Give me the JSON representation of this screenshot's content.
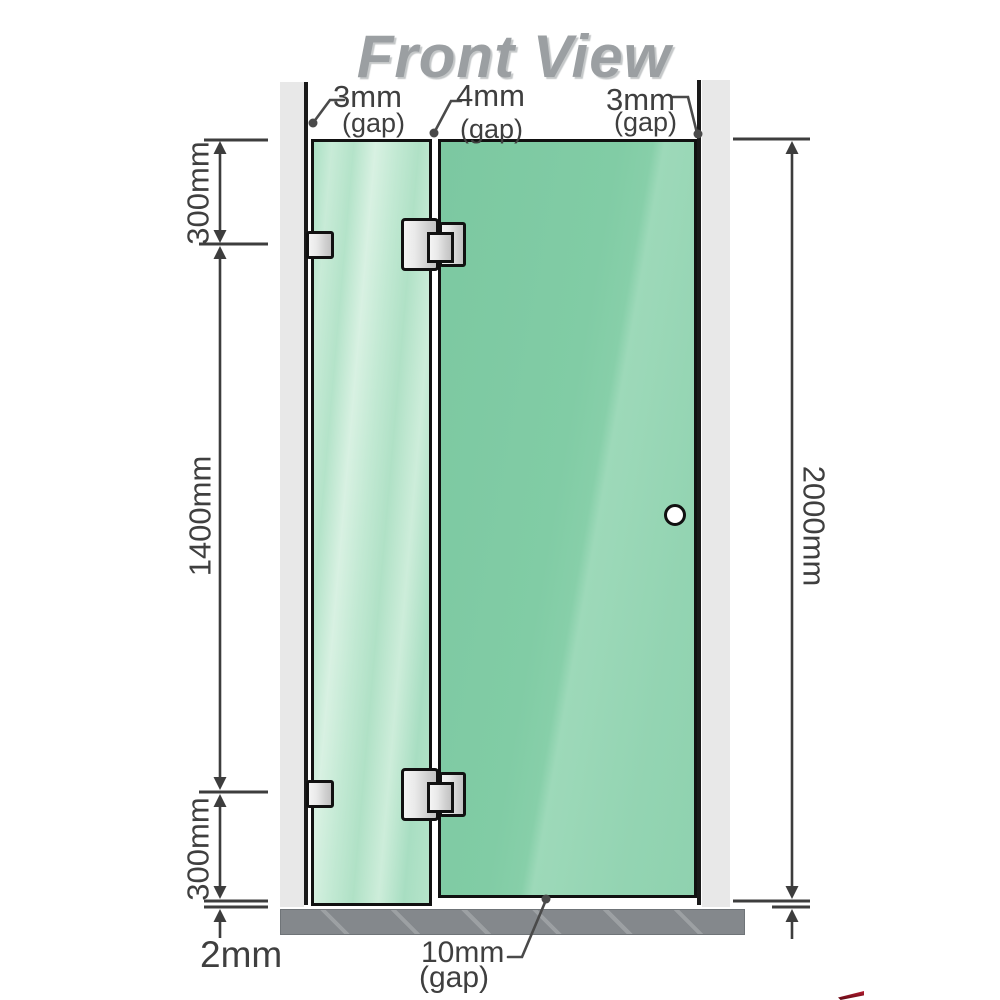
{
  "title": "Front View",
  "gap_labels": {
    "top_left": {
      "value": "3mm",
      "qualifier": "(gap)"
    },
    "top_middle": {
      "value": "4mm",
      "qualifier": "(gap)"
    },
    "top_right": {
      "value": "3mm",
      "qualifier": "(gap)"
    },
    "bottom_door": {
      "value": "10mm",
      "qualifier": "(gap)"
    },
    "bottom_panel": {
      "value": "2mm"
    }
  },
  "side_dimensions": {
    "left_top": "300mm",
    "left_middle": "1400mm",
    "left_bottom": "300mm",
    "right_total": "2000mm"
  },
  "colors": {
    "glass_fixed_panel": "#b7e4cb",
    "glass_door_panel": "#7ecaa3",
    "wall_channel": "#e8e8e8",
    "hardware_silver": "#d9d9d9",
    "floor_base": "#84888c",
    "dimension_lines": "#3d3d3d",
    "title_gray": "#9b9fa2",
    "outline_black": "#111111",
    "logo_red": "#8f1020"
  }
}
